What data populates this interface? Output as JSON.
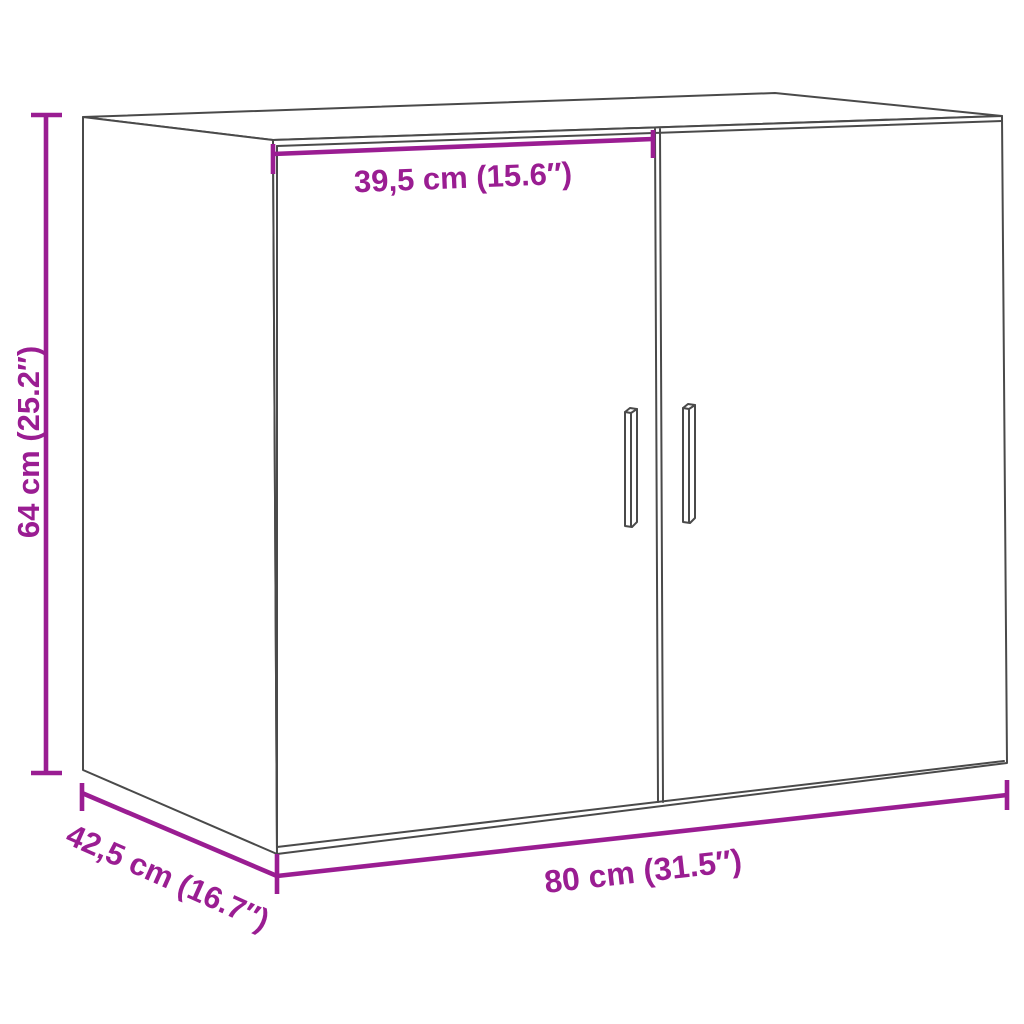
{
  "diagram": {
    "kind": "furniture-dimension-drawing",
    "subject": "wall cabinet with two doors and vertical bar handles"
  },
  "colors": {
    "dimension_accent": "#9A1D92",
    "drawing_line": "#4a4a4a",
    "background": "#ffffff"
  },
  "dimensions": {
    "height": {
      "label": "64 cm (25.2″)",
      "value_cm": "64",
      "value_in": "25.2"
    },
    "width": {
      "label": "80 cm (31.5″)",
      "value_cm": "80",
      "value_in": "31.5"
    },
    "depth": {
      "label": "42,5 cm (16.7″)",
      "value_cm": "42,5",
      "value_in": "16.7"
    },
    "door_width": {
      "label": "39,5 cm (15.6″)",
      "value_cm": "39,5",
      "value_in": "15.6"
    }
  }
}
